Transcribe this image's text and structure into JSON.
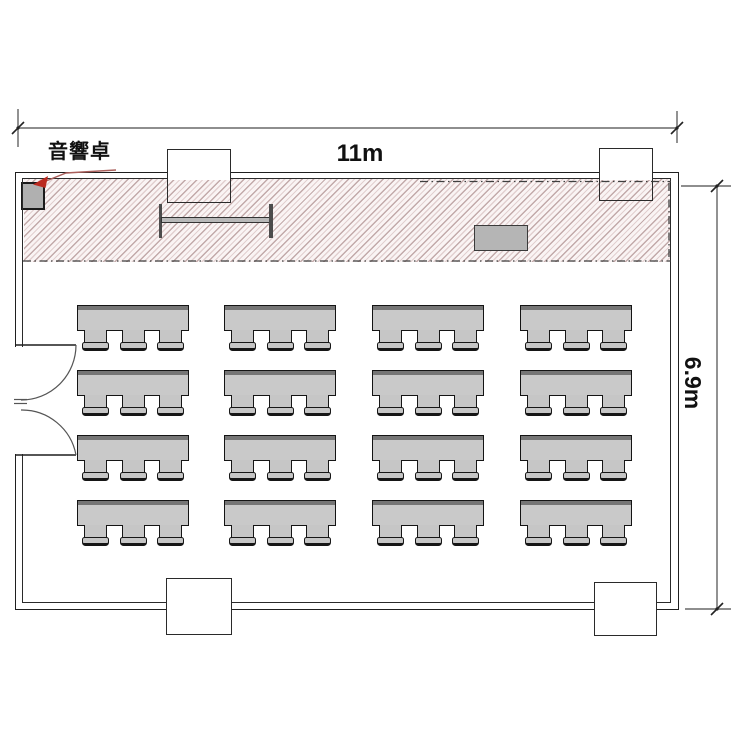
{
  "labels": {
    "audio_console": "音響卓",
    "width_dimension": "11m",
    "height_dimension": "6.9m"
  },
  "room": {
    "width_meters": "11m",
    "depth_meters": "6.9m"
  },
  "stage": {
    "objects": [
      "audio-console",
      "long-table",
      "podium"
    ],
    "hatched": true
  },
  "furniture": {
    "table_rows": 4,
    "table_columns": 4,
    "table_count": 16,
    "chairs_per_table": 3,
    "total_chairs": 48
  },
  "colors": {
    "furniture_fill": "#c9c9c9",
    "hatch_line": "#b39c9c",
    "annotation_red": "#b5342a",
    "outline": "#1f1f1f"
  }
}
